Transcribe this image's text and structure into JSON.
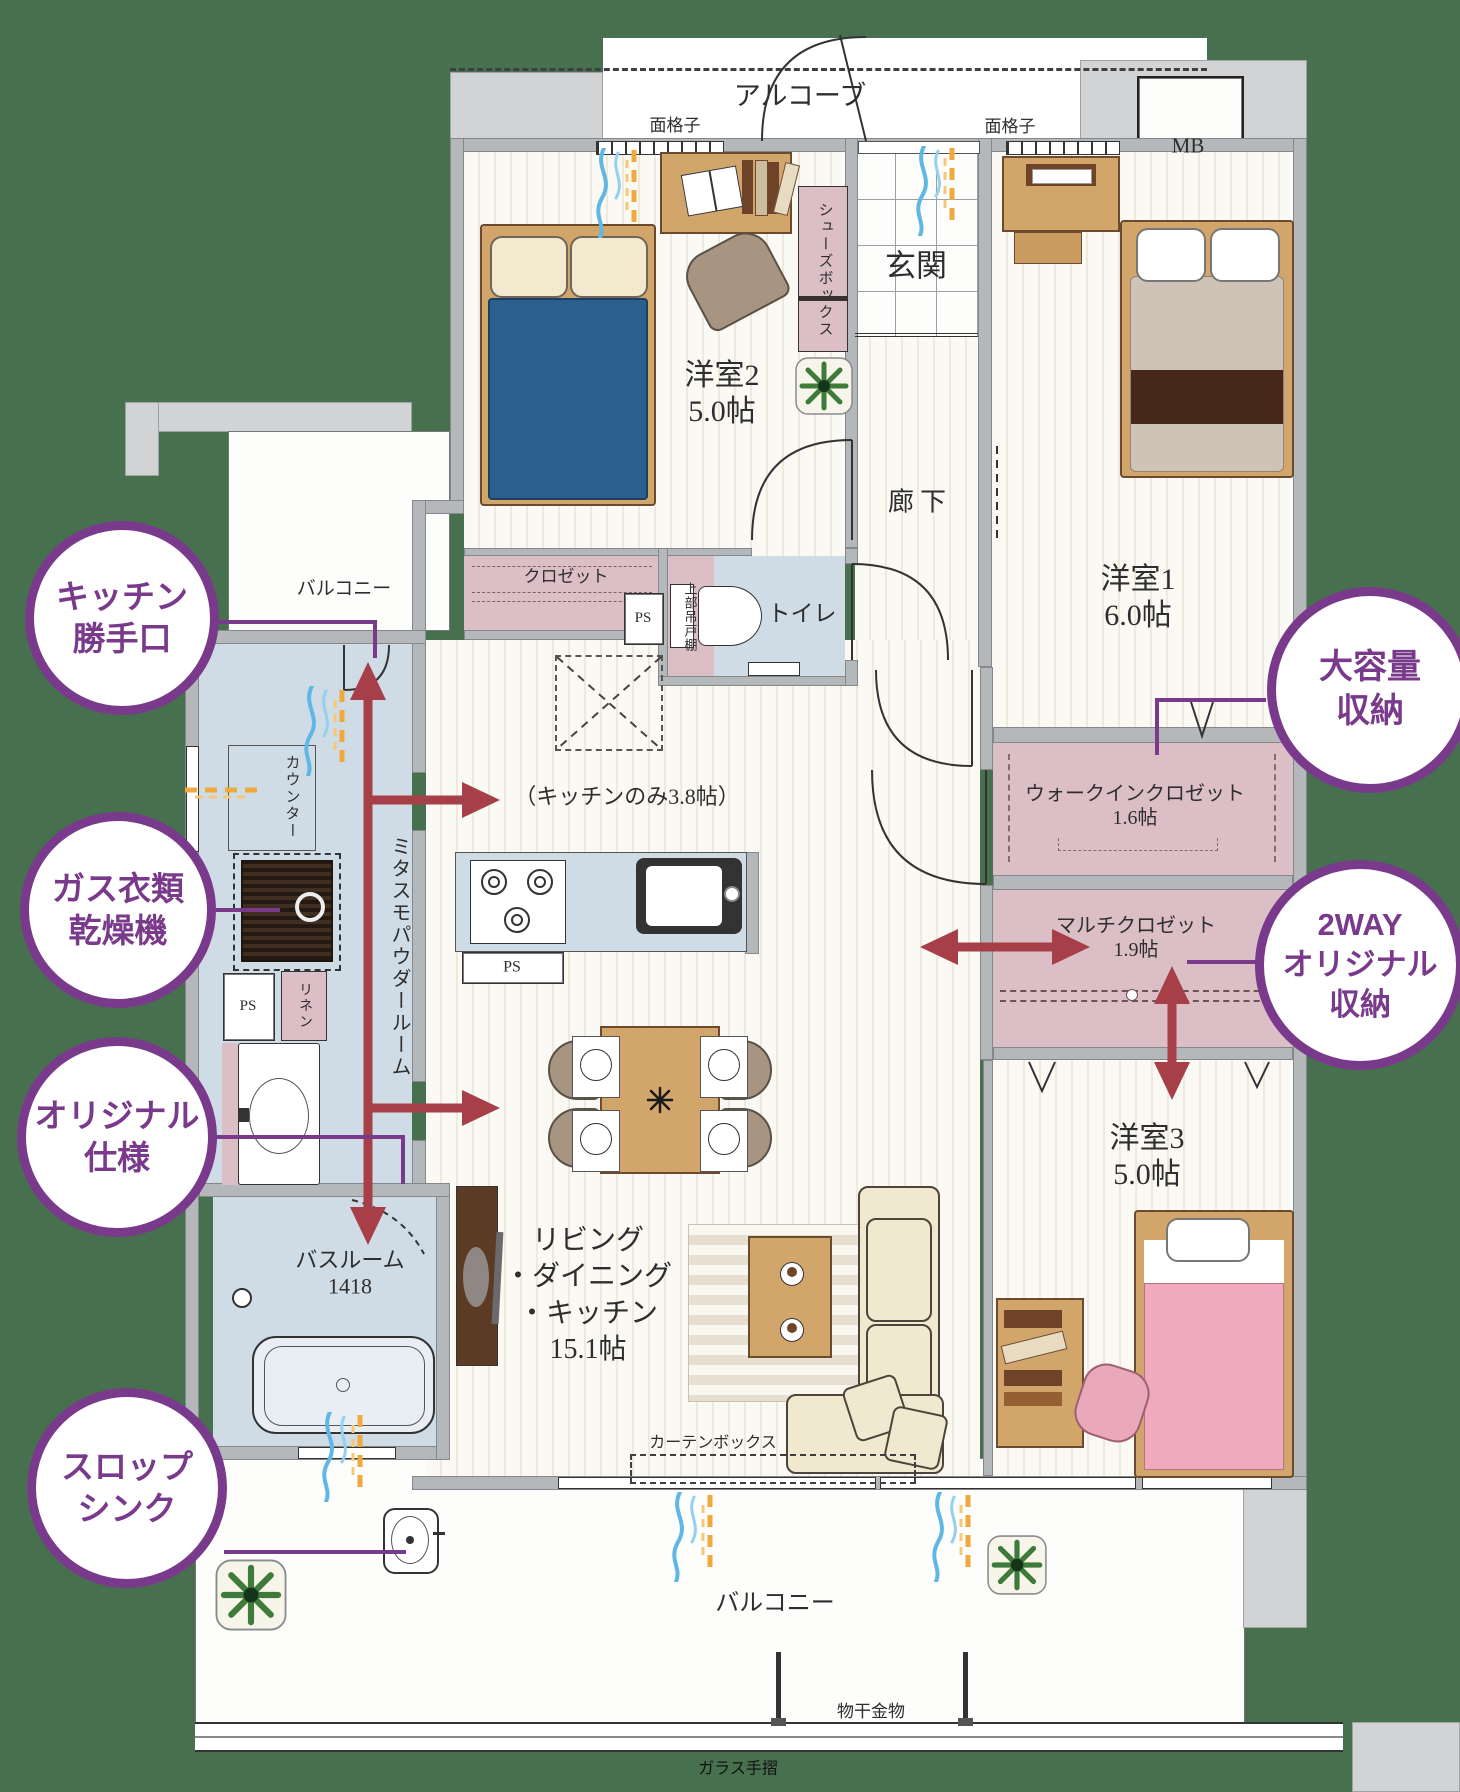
{
  "plan": {
    "alcove": "アルコーブ",
    "grille": "面格子",
    "mb": "MB",
    "entrance": "玄関",
    "shoe_box": "シューズボックス",
    "bedroom2_name": "洋室2",
    "bedroom2_size": "5.0帖",
    "corridor": "廊下",
    "bedroom1_name": "洋室1",
    "bedroom1_size": "6.0帖",
    "closet": "クロゼット",
    "ps": "PS",
    "upper_shelf": "上部吊戸棚",
    "toilet": "トイレ",
    "kitchen_only": "（キッチンのみ3.8帖）",
    "mitasumo": "ミタスモパウダールーム",
    "counter": "カウンター",
    "linen": "リネン",
    "wic_name": "ウォークインクロゼット",
    "wic_size": "1.6帖",
    "multi_name": "マルチクロゼット",
    "multi_size": "1.9帖",
    "bedroom3_name": "洋室3",
    "bedroom3_size": "5.0帖",
    "ldk_line1": "リビング",
    "ldk_line2": "・ダイニング",
    "ldk_line3": "・キッチン",
    "ldk_size": "15.1帖",
    "bath_name": "バスルーム",
    "bath_size": "1418",
    "curtain_box": "カーテンボックス",
    "balcony": "バルコニー",
    "laundry_hw": "物干金物",
    "glass_rail": "ガラス手摺"
  },
  "badges": [
    {
      "id": "kitchen-back-door",
      "lines": [
        "キッチン",
        "勝手口"
      ]
    },
    {
      "id": "gas-clothes-dryer",
      "lines": [
        "ガス衣類",
        "乾燥機"
      ]
    },
    {
      "id": "original-spec",
      "lines": [
        "オリジナル",
        "仕様"
      ]
    },
    {
      "id": "slop-sink",
      "lines": [
        "スロップ",
        "シンク"
      ]
    },
    {
      "id": "large-storage",
      "lines": [
        "大容量",
        "収納"
      ]
    },
    {
      "id": "two-way-storage",
      "lines": [
        "2WAY",
        "オリジナル",
        "収納"
      ]
    }
  ],
  "colors": {
    "background_green": "#47714e",
    "badge_purple": "#7a3a8c",
    "arrow_red": "#a63f48",
    "floor_cream": "#f6f2e7",
    "closet_pink": "#dcbfc6",
    "water_blue": "#cfdce6",
    "wall_gray": "#b4b8bb",
    "wood": "#d2a56b"
  }
}
